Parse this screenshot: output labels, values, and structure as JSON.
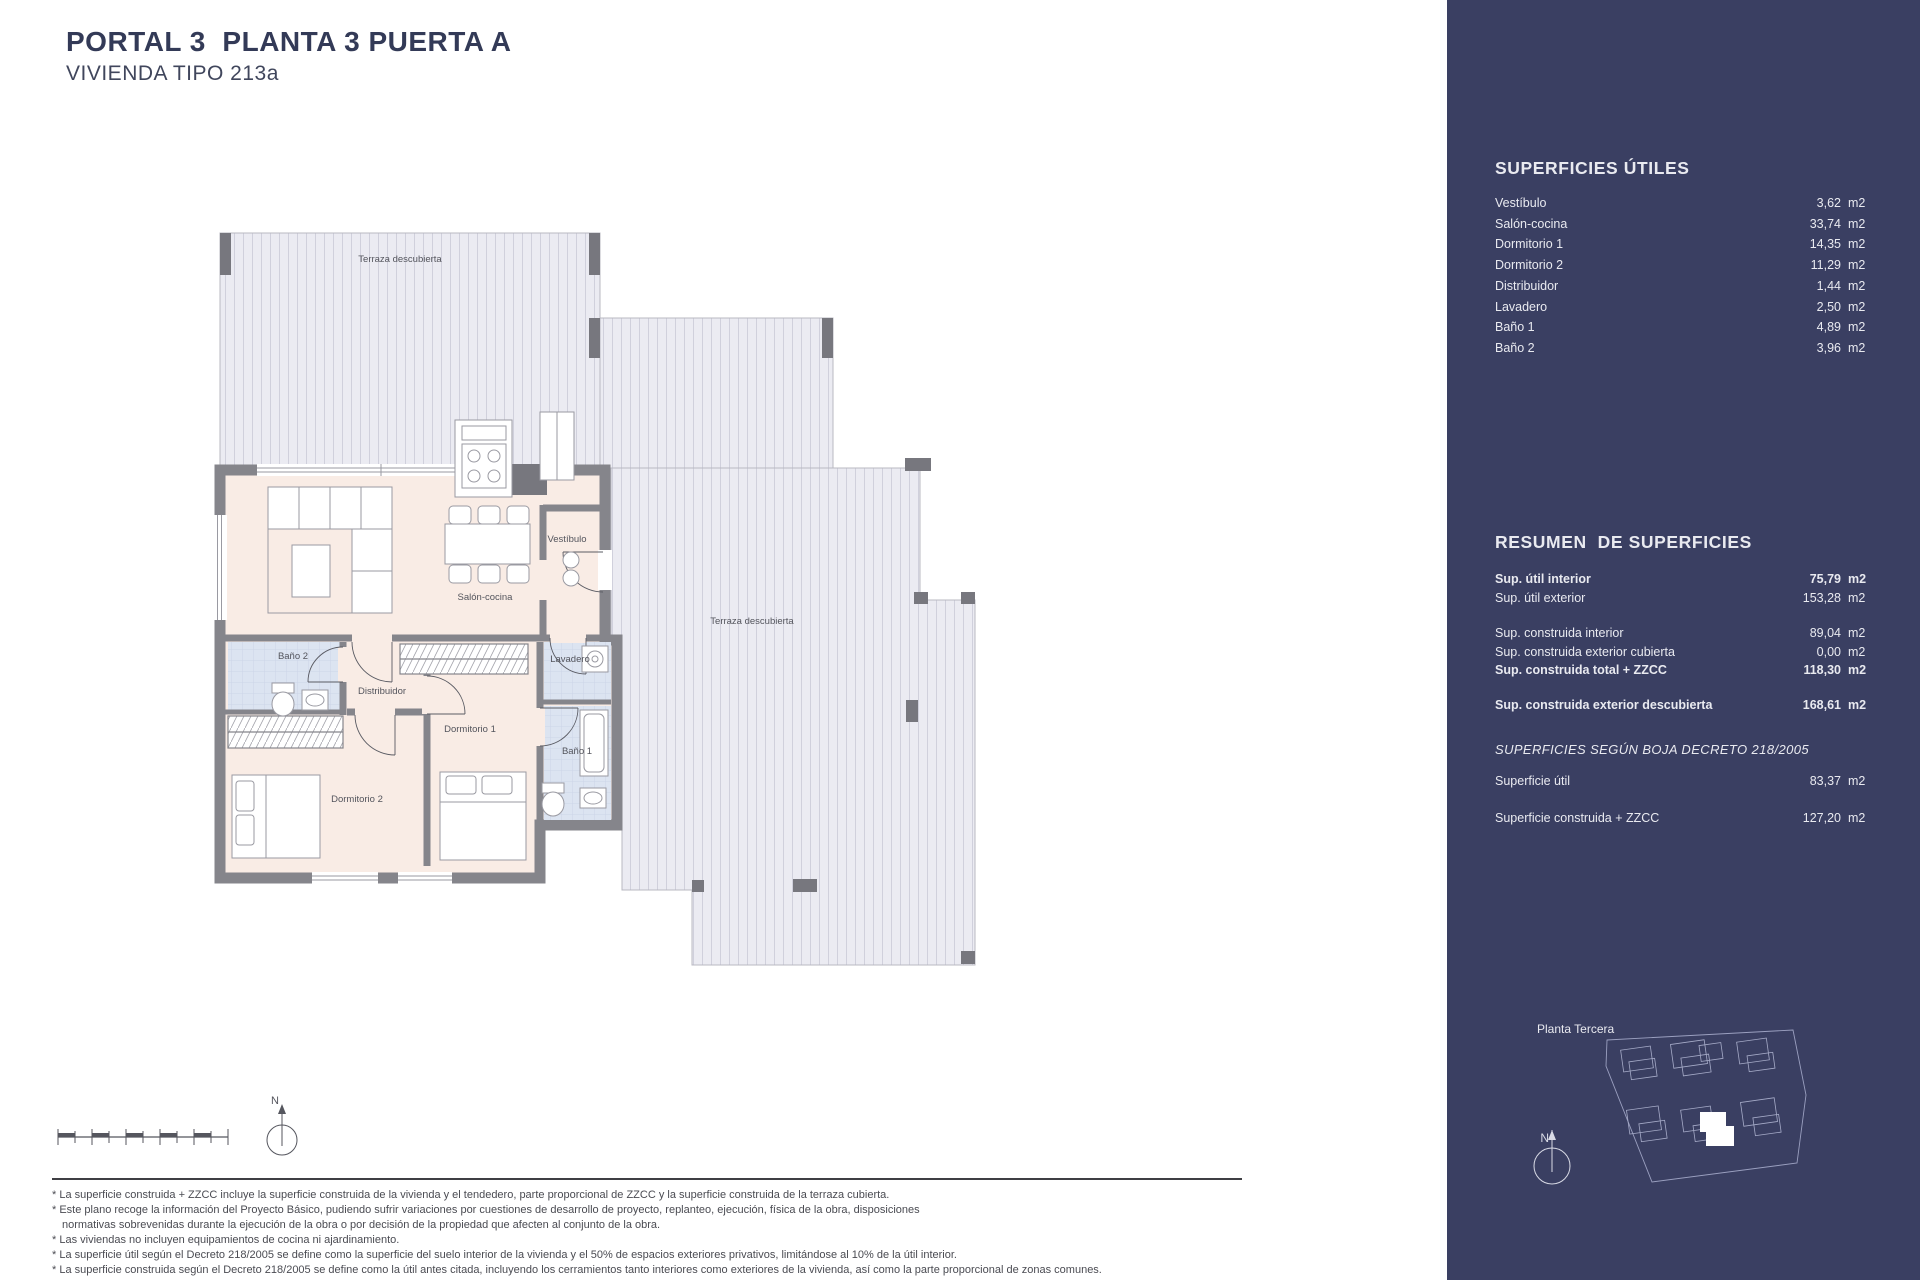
{
  "header": {
    "title": "PORTAL 3  PLANTA 3 PUERTA A",
    "subtitle": "VIVIENDA TIPO 213a"
  },
  "plan": {
    "labels": {
      "terraza_top": "Terraza descubierta",
      "terraza_right": "Terraza descubierta",
      "salon": "Salón-cocina",
      "vestibulo": "Vestíbulo",
      "lavadero": "Lavadero",
      "bano1": "Baño 1",
      "bano2": "Baño 2",
      "distribuidor": "Distribuidor",
      "dormitorio1": "Dormitorio 1",
      "dormitorio2": "Dormitorio 2"
    }
  },
  "compass": {
    "north": "N"
  },
  "sidebar": {
    "superficies_utiles": {
      "title": "SUPERFICIES ÚTILES",
      "rows": [
        {
          "label": "Vestíbulo",
          "value": "3,62",
          "unit": "m2"
        },
        {
          "label": "Salón-cocina",
          "value": "33,74",
          "unit": "m2"
        },
        {
          "label": "Dormitorio 1",
          "value": "14,35",
          "unit": "m2"
        },
        {
          "label": "Dormitorio 2",
          "value": "11,29",
          "unit": "m2"
        },
        {
          "label": "Distribuidor",
          "value": "1,44",
          "unit": "m2"
        },
        {
          "label": "Lavadero",
          "value": "2,50",
          "unit": "m2"
        },
        {
          "label": "Baño 1",
          "value": "4,89",
          "unit": "m2"
        },
        {
          "label": "Baño 2",
          "value": "3,96",
          "unit": "m2"
        }
      ]
    },
    "resumen": {
      "title": "RESUMEN  DE SUPERFICIES",
      "rows": [
        {
          "label": "Sup. útil interior",
          "value": "75,79",
          "unit": "m2"
        },
        {
          "label": "Sup. útil exterior",
          "value": "153,28",
          "unit": "m2"
        },
        {
          "label": "Sup. construida interior",
          "value": "89,04",
          "unit": "m2"
        },
        {
          "label": "Sup. construida exterior cubierta",
          "value": "0,00",
          "unit": "m2"
        },
        {
          "label": "Sup. construida total + ZZCC",
          "value": "118,30",
          "unit": "m2"
        },
        {
          "label": "Sup. construida exterior descubierta",
          "value": "168,61",
          "unit": "m2"
        }
      ]
    },
    "boja": {
      "title": "SUPERFICIES SEGÚN BOJA DECRETO 218/2005",
      "rows": [
        {
          "label": "Superficie útil",
          "value": "83,37",
          "unit": "m2"
        },
        {
          "label": "Superficie construida + ZZCC",
          "value": "127,20",
          "unit": "m2"
        }
      ]
    },
    "minimap": {
      "label": "Planta Tercera",
      "north": "N"
    }
  },
  "footnotes": [
    "* La superficie construida + ZZCC incluye la superficie construida de la vivienda y el tendedero, parte proporcional de ZZCC y la superficie construida de la terraza cubierta.",
    "* Este plano recoge la información del Proyecto Básico, pudiendo sufrir variaciones por cuestiones de desarrollo de proyecto, replanteo, ejecución, física de la obra, disposiciones",
    "normativas sobrevenidas durante la ejecución de la obra o por decisión de la propiedad que afecten al conjunto de la obra.",
    "* Las viviendas no incluyen equipamientos de cocina ni ajardinamiento.",
    "* La superficie útil según el Decreto 218/2005 se define como la superficie del suelo interior de la vivienda y el 50% de espacios exteriores privativos, limitándose al 10% de la útil interior.",
    "* La superficie construida según el Decreto 218/2005 se define como la útil antes citada, incluyendo los cerramientos tanto interiores como exteriores de la vivienda, así como la parte proporcional de zonas comunes."
  ]
}
